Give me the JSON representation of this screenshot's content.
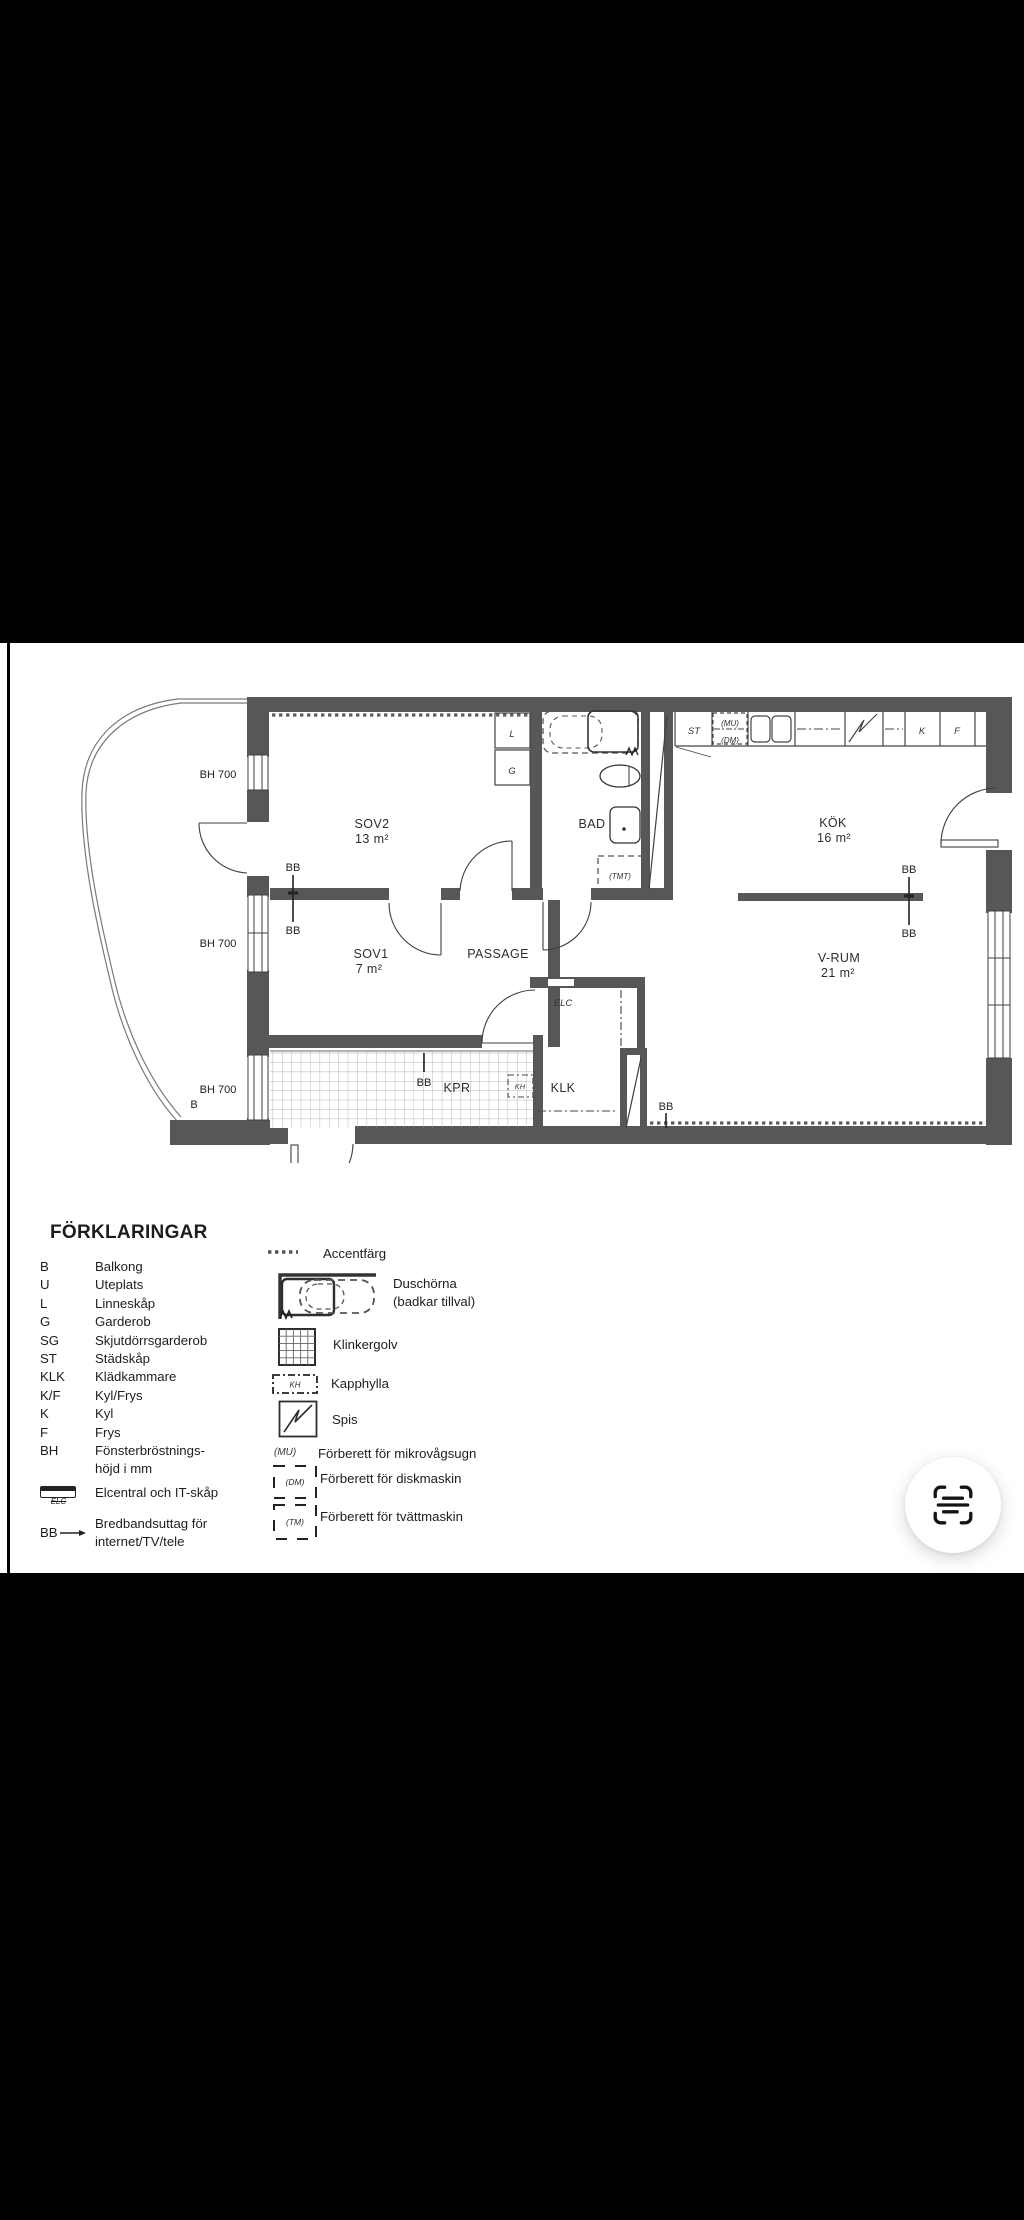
{
  "plan": {
    "rooms": {
      "sov2": {
        "name": "SOV2",
        "area": "13 m²"
      },
      "sov1": {
        "name": "SOV1",
        "area": "7 m²"
      },
      "bad": {
        "name": "BAD"
      },
      "kok": {
        "name": "KÖK",
        "area": "16 m²"
      },
      "vrum": {
        "name": "V-RUM",
        "area": "21 m²"
      },
      "passage": {
        "name": "PASSAGE"
      },
      "kpr": {
        "name": "KPR"
      },
      "klk": {
        "name": "KLK"
      },
      "elc": {
        "name": "ELC"
      },
      "kh": {
        "name": "KH"
      }
    },
    "fixtures": {
      "l": "L",
      "g": "G",
      "st": "ST",
      "mu": "(MU)",
      "dm": "(DM)",
      "k": "K",
      "f": "F",
      "tmt": "(TMT)"
    },
    "markers": {
      "bb": "BB",
      "bh700": "BH 700",
      "b": "B"
    }
  },
  "legend": {
    "title": "FÖRKLARINGAR",
    "abbreviations": [
      {
        "abbr": "B",
        "label": "Balkong"
      },
      {
        "abbr": "U",
        "label": "Uteplats"
      },
      {
        "abbr": "L",
        "label": "Linneskåp"
      },
      {
        "abbr": "G",
        "label": "Garderob"
      },
      {
        "abbr": "SG",
        "label": "Skjutdörrsgarderob"
      },
      {
        "abbr": "ST",
        "label": "Städskåp"
      },
      {
        "abbr": "KLK",
        "label": "Klädkammare"
      },
      {
        "abbr": "K/F",
        "label": "Kyl/Frys"
      },
      {
        "abbr": "K",
        "label": "Kyl"
      },
      {
        "abbr": "F",
        "label": "Frys"
      },
      {
        "abbr": "BH",
        "label": "Fönsterbröstnings-\nhöjd i mm"
      },
      {
        "abbr": "ELC",
        "label": "Elcentral och IT-skåp"
      },
      {
        "abbr": "BB",
        "label": "Bredbandsuttag för\ninternet/TV/tele"
      }
    ],
    "symbols": [
      {
        "label": "Accentfärg"
      },
      {
        "label": "Duschörna\n(badkar tillval)"
      },
      {
        "label": "Klinkergolv"
      },
      {
        "label": "Kapphylla"
      },
      {
        "label": "Spis"
      },
      {
        "label": "Förberett för mikrovågsugn"
      },
      {
        "label": "Förberett för diskmaskin"
      },
      {
        "label": "Förberett för tvättmaskin"
      }
    ],
    "icon_labels": {
      "kh": "KH",
      "elc": "ELC",
      "mu": "(MU)",
      "dm": "(DM)",
      "tm": "(TM)"
    }
  },
  "colors": {
    "wall": "#575757",
    "line": "#3f3f3f",
    "paper": "#ffffff",
    "bar": "#000000"
  }
}
